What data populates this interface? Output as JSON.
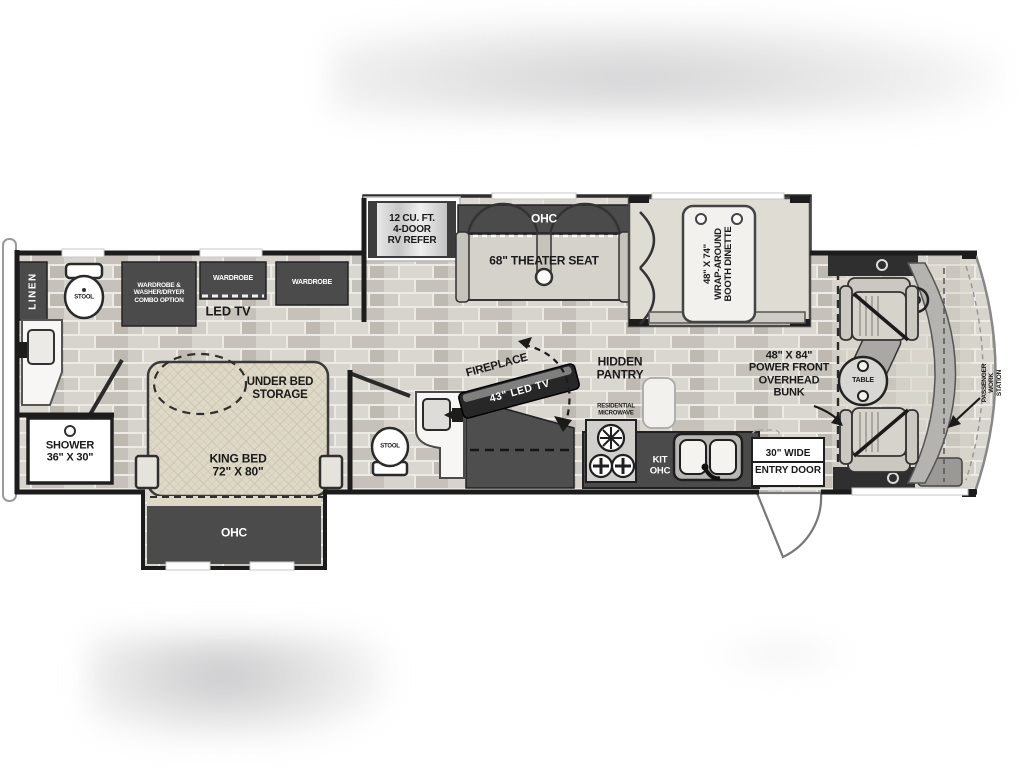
{
  "page": {
    "type": "rv-floorplan-photo",
    "background": "#ffffff"
  },
  "colors": {
    "wall": "#1c1c1c",
    "cabinet_dark": "#4b4b4b",
    "floor_plank_light": "#d8d5cf",
    "floor_plank_dark": "#c3bfb8",
    "bed_quilt": "#ded9c7",
    "slide_floor": "#e3e0d9",
    "label_text": "#1a1a1a",
    "label_text_inverse": "#ffffff",
    "window_gap": "#ffffff",
    "windshield_line": "#888888"
  },
  "labels": {
    "linen": "LINEN",
    "stool_rear": "STOOL",
    "stool_mid": "STOOL",
    "wardrobe_combo": "WARDROBE &\nWASHER/DRYER\nCOMBO OPTION",
    "wardrobe_1": "WARDROBE",
    "wardrobe_2": "WARDROBE",
    "led_tv": "LED TV",
    "refrigerator": "12 CU. FT.\n4-DOOR\nRV REFER",
    "ohc_theater": "OHC",
    "theater_seat": "68\" THEATER SEAT",
    "booth_dinette": "48\" X 74\"\nWRAP-AROUND\nBOOTH DINETTE",
    "shower": "SHOWER\n36\" X 30\"",
    "under_bed_storage": "UNDER BED\nSTORAGE",
    "king_bed": "KING BED\n72\" X 80\"",
    "ohc_bed_slide": "OHC",
    "fireplace": "FIREPLACE",
    "fireplace_tv": "43\" LED TV",
    "hidden_pantry": "HIDDEN\nPANTRY",
    "residential_microwave": "RESIDENTIAL\nMICROWAVE",
    "kit_ohc": "KIT\nOHC",
    "entry_door_line1": "30\" WIDE",
    "entry_door_line2": "ENTRY DOOR",
    "overhead_bunk": "48\" X 84\"\nPOWER FRONT\nOVERHEAD\nBUNK",
    "table": "TABLE",
    "passenger_work_station": "PASSENGER\nWORK STATION"
  }
}
